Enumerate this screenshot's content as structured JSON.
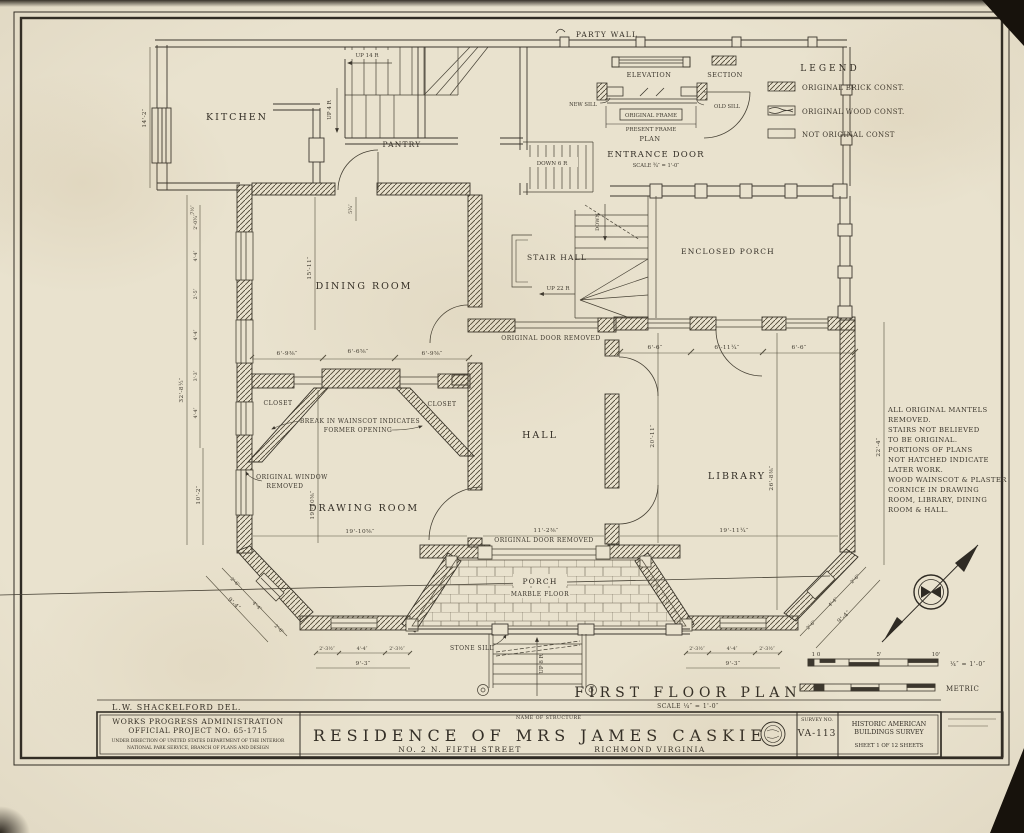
{
  "sheet": {
    "party_wall": "PARTY WALL",
    "legend": {
      "title": "LEGEND",
      "brick": "ORIGINAL BRICK CONST.",
      "wood": "ORIGINAL WOOD CONST.",
      "none": "NOT ORIGINAL CONST"
    },
    "detail": {
      "elevation": "ELEVATION",
      "section": "SECTION",
      "new_sill": "NEW SILL",
      "old_sill": "OLD SILL",
      "original_frame": "ORIGINAL FRAME",
      "present_frame": "PRESENT FRAME",
      "plan": "PLAN",
      "title": "ENTRANCE DOOR",
      "scale": "SCALE ¾″ = 1'-0″"
    },
    "rooms": {
      "kitchen": "KITCHEN",
      "pantry": "PANTRY",
      "dining": "DINING ROOM",
      "stair_hall": "STAIR HALL",
      "enclosed_porch": "ENCLOSED PORCH",
      "hall": "HALL",
      "library": "LIBRARY",
      "drawing": "DRAWING ROOM",
      "porch": "PORCH",
      "closet": "CLOSET"
    },
    "stairs": {
      "up14": "UP 14 R",
      "up4": "UP 4 R",
      "down6": "DOWN 6 R",
      "down": "DOWN",
      "up22": "UP 22 R",
      "up8": "UP 8 R"
    },
    "ann": {
      "door_removed": "ORIGINAL DOOR REMOVED",
      "wainscot1": "BREAK IN WAINSCOT INDICATES",
      "wainscot2": "FORMER OPENING",
      "window1": "ORIGINAL WINDOW",
      "window2": "REMOVED",
      "marble": "MARBLE FLOOR",
      "stone_sill": "STONE SILL"
    },
    "notes": [
      "ALL ORIGINAL MANTELS",
      "REMOVED.",
      "STAIRS NOT BELIEVED",
      "TO BE ORIGINAL.",
      "PORTIONS OF PLANS",
      "NOT HATCHED INDICATE",
      "LATER WORK.",
      "WOOD WAINSCOT & PLASTER",
      "CORNICE IN DRAWING",
      "ROOM, LIBRARY, DINING",
      "ROOM & HALL."
    ],
    "dims": {
      "kh": "14'-2″",
      "ltot": "32'-8½″",
      "l7": "7½″",
      "l1": "2'-0¾″",
      "l2": "4'-4″",
      "l3": "2'-5″",
      "l4": "4'-4″",
      "l5": "3'-3″",
      "l6": "4'-4″",
      "l10": "10'-2″",
      "din": "15'-11″",
      "din_s": "5¾″",
      "m1": "6'-9⅜″",
      "m2": "6'-6⅝″",
      "m3": "6'-9⅝″",
      "p1": "6'-6″",
      "p2": "6'-11¼″",
      "p3": "6'-6″",
      "hallh": "20'-11″",
      "libh": "26'-8⅜″",
      "rh": "22'-4″",
      "draww": "19'-10⅝″",
      "drawh": "19'-10⅝″",
      "hallw": "11'-2⅜″",
      "libw": "19'-11¼″",
      "b1": "2'-6″",
      "b2": "4'-4″",
      "b3": "2'-6″",
      "bt": "9'-4″",
      "f1": "2'-3½″",
      "f2": "4'-4″",
      "f3": "2'-3½″",
      "ft": "9'-3″"
    },
    "plan": {
      "title": "FIRST FLOOR PLAN",
      "scale": "SCALE ¼″ = 1'-0″"
    },
    "scalebar": {
      "t0": "1 0",
      "t5": "5'",
      "t10": "10'",
      "feet": "¼″ = 1'-0″",
      "metric": "METRIC"
    },
    "tb": {
      "del": "L.W. SHACKELFORD   DEL.",
      "wpa1": "WORKS PROGRESS ADMINISTRATION",
      "wpa2": "OFFICIAL PROJECT NO. 65-1715",
      "wpa3": "UNDER DIRECTION OF UNITED STATES DEPARTMENT OF THE INTERIOR",
      "wpa4": "NATIONAL PARK SERVICE, BRANCH OF PLANS AND DESIGN",
      "nos": "NAME OF STRUCTURE",
      "title": "RESIDENCE OF MRS JAMES CASKIE",
      "addr": "NO. 2 N. FIFTH STREET",
      "city": "RICHMOND VIRGINIA",
      "survey_label": "SURVEY NO.",
      "survey": "VA-113",
      "habs1": "HISTORIC AMERICAN",
      "habs2": "BUILDINGS SURVEY",
      "sheet": "SHEET 1 OF 12 SHEETS"
    }
  }
}
